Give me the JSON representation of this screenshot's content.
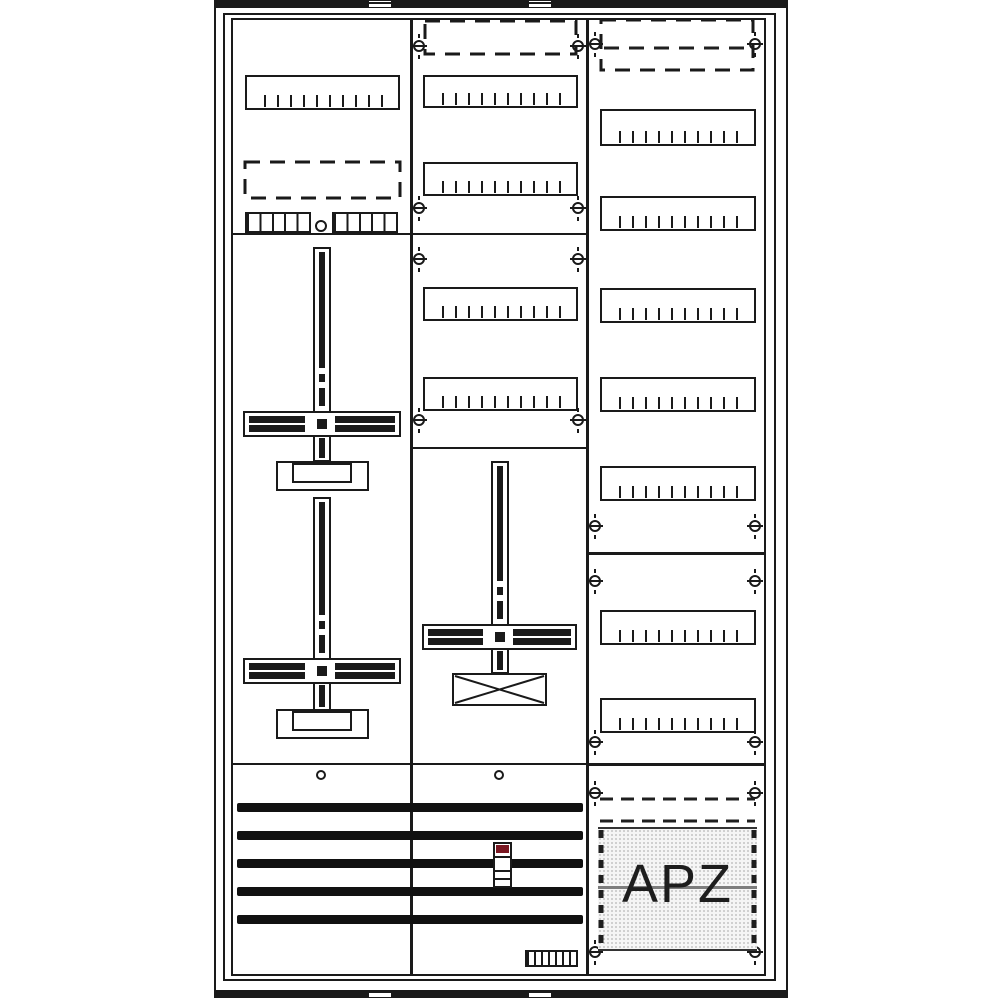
{
  "labels": {
    "apz": "APZ"
  },
  "colors": {
    "line": "#1a1a1a",
    "background": "#ffffff",
    "fuse_cap": "#7a1722",
    "apz_fill": "#f5f5f5",
    "apz_dot": "#c4c4c4",
    "apz_divider": "#7d7d7d",
    "apz_edge": "#1f1f1f"
  },
  "frame": {
    "outer": {
      "x": 214,
      "y": 2,
      "w": 574,
      "h": 991
    },
    "inner": {
      "x": 223,
      "y": 13,
      "w": 553,
      "h": 968
    },
    "top_band": {
      "x": 214,
      "y": 0,
      "w": 574,
      "h": 8
    },
    "bottom_band": {
      "x": 214,
      "y": 990,
      "w": 574,
      "h": 8
    },
    "band_gaps": [
      {
        "x": 369,
        "w": 22
      },
      {
        "x": 529,
        "w": 22
      }
    ]
  },
  "columns": [
    {
      "id": "left",
      "x": 231,
      "y": 18,
      "w": 181,
      "h": 958
    },
    {
      "id": "middle",
      "x": 411,
      "y": 18,
      "w": 177,
      "h": 958
    },
    {
      "id": "right",
      "x": 587,
      "y": 18,
      "w": 179,
      "h": 958
    }
  ],
  "dividers": [
    {
      "id": "left-sec-1",
      "x": 233,
      "y": 233,
      "w": 177,
      "t": 2
    },
    {
      "id": "middle-sec-1",
      "x": 413,
      "y": 233,
      "w": 173,
      "t": 2
    },
    {
      "id": "middle-sec-2",
      "x": 413,
      "y": 447,
      "w": 173,
      "t": 2
    },
    {
      "id": "left-sec-2",
      "x": 233,
      "y": 763,
      "w": 177,
      "t": 2
    },
    {
      "id": "middle-sec-3",
      "x": 413,
      "y": 763,
      "w": 173,
      "t": 2
    },
    {
      "id": "right-sec-1",
      "x": 589,
      "y": 552,
      "w": 175,
      "t": 3
    },
    {
      "id": "right-sec-2",
      "x": 589,
      "y": 763,
      "w": 175,
      "t": 3
    }
  ],
  "din_rails": [
    {
      "id": "left-rail-1",
      "x": 245,
      "y": 75,
      "w": 155,
      "h": 35
    },
    {
      "id": "middle-rail-1",
      "x": 423,
      "y": 75,
      "w": 155,
      "h": 33
    },
    {
      "id": "middle-rail-2",
      "x": 423,
      "y": 162,
      "w": 155,
      "h": 34
    },
    {
      "id": "middle-rail-3",
      "x": 423,
      "y": 287,
      "w": 155,
      "h": 34
    },
    {
      "id": "middle-rail-4",
      "x": 423,
      "y": 377,
      "w": 155,
      "h": 34
    },
    {
      "id": "right-rail-1",
      "x": 600,
      "y": 109,
      "w": 156,
      "h": 37
    },
    {
      "id": "right-rail-2",
      "x": 600,
      "y": 196,
      "w": 156,
      "h": 35
    },
    {
      "id": "right-rail-3",
      "x": 600,
      "y": 288,
      "w": 156,
      "h": 35
    },
    {
      "id": "right-rail-4",
      "x": 600,
      "y": 377,
      "w": 156,
      "h": 35
    },
    {
      "id": "right-rail-5",
      "x": 600,
      "y": 466,
      "w": 156,
      "h": 35
    },
    {
      "id": "right-rail-6",
      "x": 600,
      "y": 610,
      "w": 156,
      "h": 35
    },
    {
      "id": "right-rail-7",
      "x": 600,
      "y": 698,
      "w": 156,
      "h": 35
    }
  ],
  "dashed_rects": [
    {
      "id": "left-reserve",
      "x": 245,
      "y": 162,
      "w": 155,
      "h": 36
    },
    {
      "id": "middle-top-reserve",
      "x": 425,
      "y": 21,
      "w": 151,
      "h": 33
    },
    {
      "id": "right-top-reserve",
      "x": 601,
      "y": 20,
      "w": 152,
      "h": 50
    }
  ],
  "dashed_lines": [
    {
      "id": "right-top-reserve-midline",
      "x1": 604,
      "y1": 48,
      "x2": 750,
      "y2": 48,
      "dash": "15 10",
      "w": 3
    },
    {
      "id": "apz-rail-top",
      "x1": 600,
      "y1": 799,
      "x2": 755,
      "y2": 799,
      "dash": "13 8",
      "w": 3
    },
    {
      "id": "apz-rail-bottom",
      "x1": 600,
      "y1": 821,
      "x2": 755,
      "y2": 821,
      "dash": "13 8",
      "w": 3
    },
    {
      "id": "apz-edge-left",
      "x1": 601,
      "y1": 830,
      "x2": 601,
      "y2": 949,
      "dash": "8 7",
      "w": 5
    },
    {
      "id": "apz-edge-right",
      "x1": 754,
      "y1": 830,
      "x2": 754,
      "y2": 949,
      "dash": "8 7",
      "w": 5
    }
  ],
  "terminal_combs": [
    {
      "id": "left-comb-1",
      "x": 245,
      "y": 212,
      "w": 66,
      "h": 21,
      "cells": 5
    },
    {
      "id": "left-comb-2",
      "x": 332,
      "y": 212,
      "w": 66,
      "h": 21,
      "cells": 5
    },
    {
      "id": "bottom-comb",
      "x": 525,
      "y": 950,
      "w": 53,
      "h": 17,
      "cells": 7
    }
  ],
  "holes": [
    {
      "id": "left-top-hole",
      "cx": 321,
      "cy": 226,
      "r": 6
    },
    {
      "id": "left-bottom-hole",
      "cx": 321,
      "cy": 775,
      "r": 5
    },
    {
      "id": "middle-bottom-hole",
      "cx": 499,
      "cy": 775,
      "r": 5
    }
  ],
  "screws": [
    [
      419,
      46
    ],
    [
      578,
      46
    ],
    [
      419,
      208
    ],
    [
      578,
      208
    ],
    [
      419,
      259
    ],
    [
      578,
      259
    ],
    [
      419,
      420
    ],
    [
      578,
      420
    ],
    [
      595,
      44
    ],
    [
      755,
      44
    ],
    [
      595,
      526
    ],
    [
      755,
      526
    ],
    [
      595,
      581
    ],
    [
      755,
      581
    ],
    [
      595,
      742
    ],
    [
      755,
      742
    ],
    [
      595,
      793
    ],
    [
      755,
      793
    ],
    [
      595,
      952
    ],
    [
      755,
      952
    ]
  ],
  "meter_crosses": [
    {
      "id": "left-meter-1",
      "cx": 322,
      "top": 247,
      "bottom": 462,
      "cross_y": 411,
      "cross_x": 243,
      "cross_w": 158,
      "base": "cover",
      "base_x": 276,
      "base_y": 461
    },
    {
      "id": "left-meter-2",
      "cx": 322,
      "top": 497,
      "bottom": 711,
      "cross_y": 658,
      "cross_x": 243,
      "cross_w": 158,
      "base": "cover",
      "base_x": 276,
      "base_y": 709
    },
    {
      "id": "middle-meter",
      "cx": 500,
      "top": 461,
      "bottom": 674,
      "cross_y": 624,
      "cross_x": 422,
      "cross_w": 155,
      "base": "xbox",
      "base_x": 452,
      "base_y": 673
    }
  ],
  "busbars": {
    "x": 237,
    "w": 346,
    "h": 9,
    "ys": [
      803,
      831,
      859,
      887,
      915
    ]
  },
  "fuse": {
    "x": 493,
    "y": 842,
    "w": 19,
    "h": 46
  },
  "apz": {
    "box": {
      "x": 598,
      "y": 827,
      "w": 159,
      "h": 124
    },
    "divider_y": 886
  }
}
